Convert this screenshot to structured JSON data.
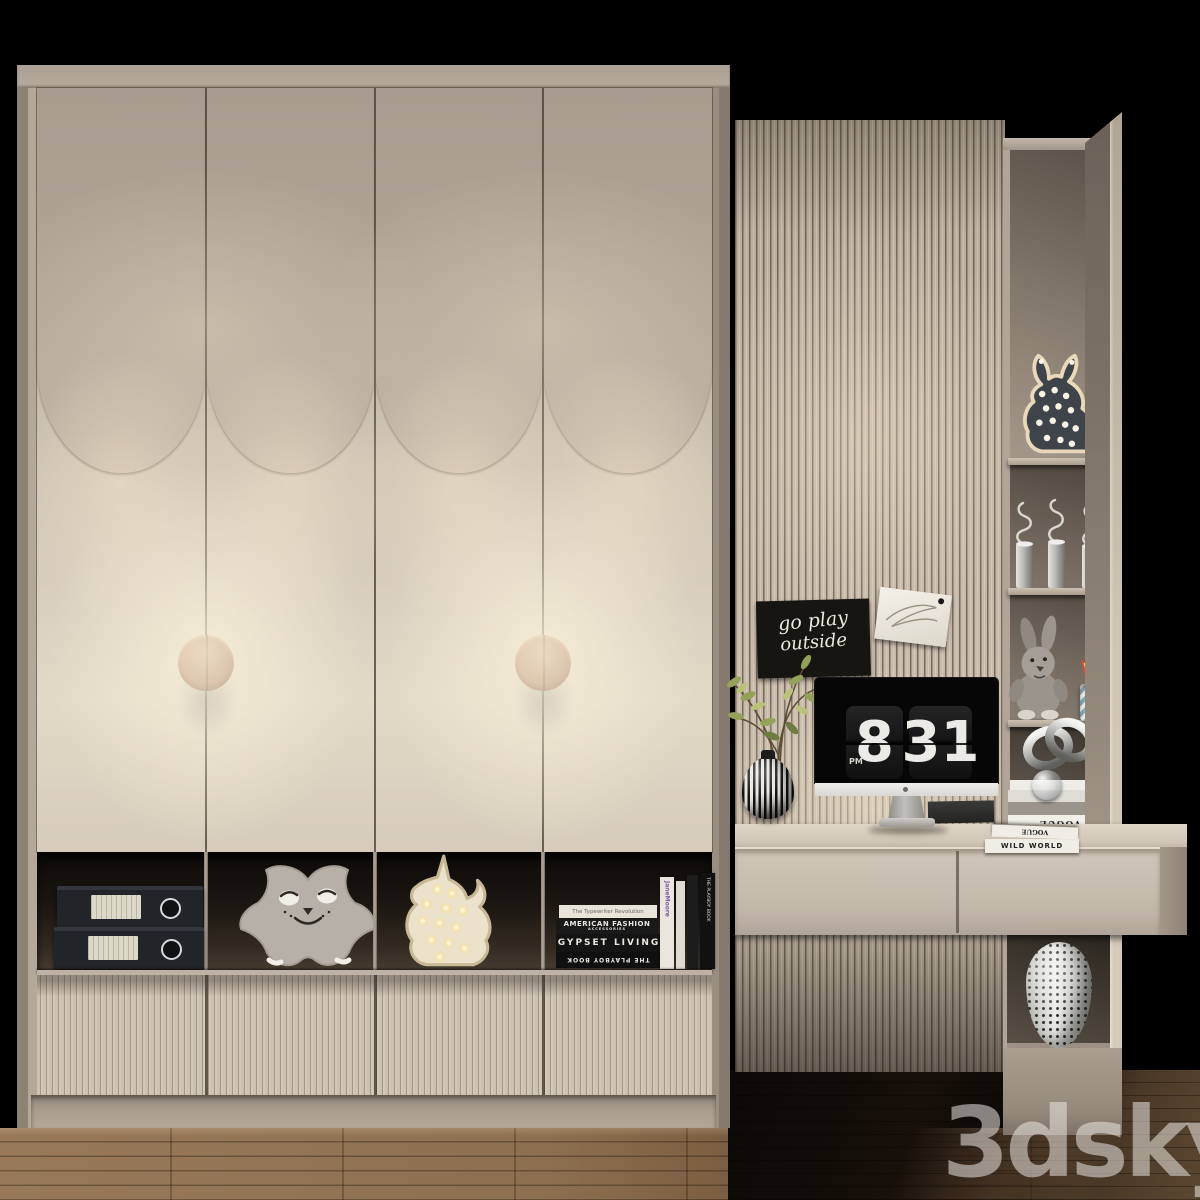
{
  "palette": {
    "background": "#000000",
    "wardrobe_body": "#b4a89b",
    "door_upper_panel": "#b0a499",
    "door_lower_panel": "#d9cfbf",
    "warm_glow": "#f3e9d4",
    "handle_copper": "#a8765c",
    "fluted_drawer": "#ccc0b2",
    "slat_wall": "#c0b3a4",
    "shelf_unit": "#b2a598",
    "desk_top": "#d5cabb",
    "floor_wood": "#8d6f51",
    "floor_shadow": "#241a10",
    "sign_background": "#171512",
    "clock_panel": "#1a1a1a"
  },
  "clock": {
    "hour": "8",
    "minute": "31",
    "meridiem": "PM"
  },
  "wall_sign": {
    "line1": "go play",
    "line2": "outside"
  },
  "cubby_books": {
    "stack": [
      "The Typewriter Revolution",
      "AMERICAN FASHION",
      "ACCESSORIES",
      "GYPSET  LIVING",
      "THE PLAYBOY BOOK"
    ],
    "spine_vertical_1": "JaneMoore",
    "spine_vertical_2": "THE PLAYBOY BOOK"
  },
  "desk_books": {
    "top_spine": "VOGUE",
    "bottom_spine": "WILD WORLD"
  },
  "shelf_books": {
    "vogue_spine": "VOGUE"
  },
  "watermark": {
    "text": "3dsky"
  }
}
